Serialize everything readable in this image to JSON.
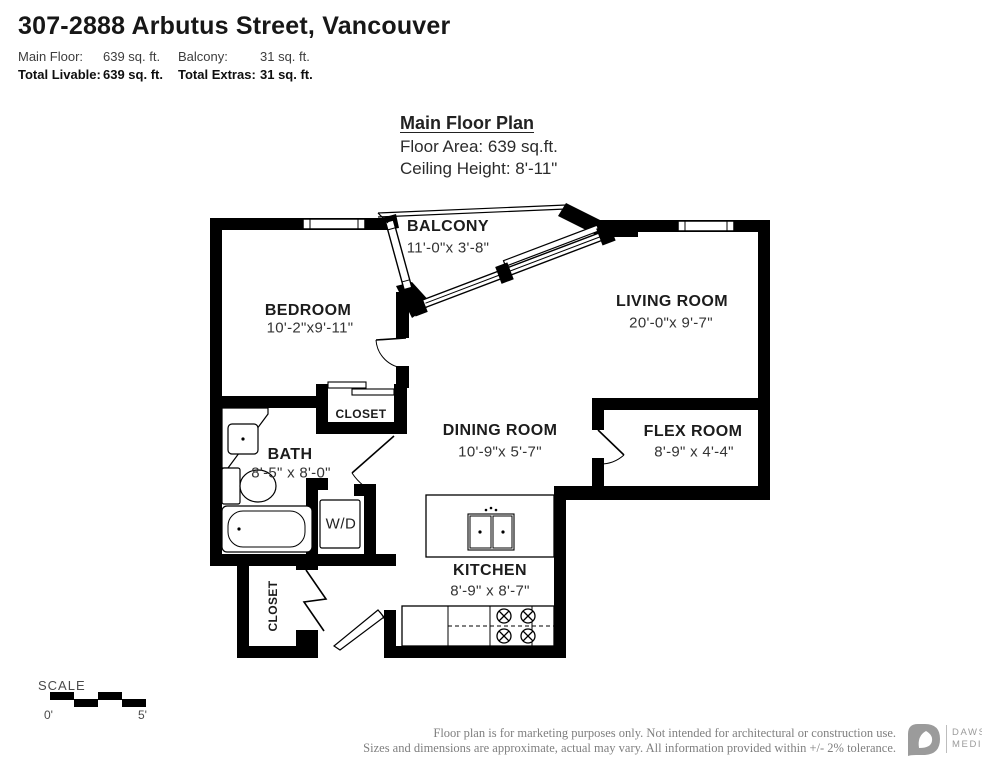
{
  "header": {
    "title": "307-2888 Arbutus Street, Vancouver",
    "stats": {
      "main_floor_label": "Main Floor:",
      "main_floor_value": "639 sq. ft.",
      "balcony_label": "Balcony:",
      "balcony_value": "31 sq. ft.",
      "total_livable_label": "Total Livable:",
      "total_livable_value": "639 sq. ft.",
      "total_extras_label": "Total Extras:",
      "total_extras_value": "31 sq. ft."
    }
  },
  "plan_header": {
    "title": "Main Floor Plan",
    "floor_area": "Floor Area: 639 sq.ft.",
    "ceiling_height": "Ceiling Height: 8'-11\""
  },
  "rooms": {
    "balcony": {
      "name": "BALCONY",
      "dims": "11'-0\"x  3'-8\""
    },
    "bedroom": {
      "name": "BEDROOM",
      "dims": "10'-2\"x9'-11\""
    },
    "living": {
      "name": "LIVING ROOM",
      "dims": "20'-0\"x  9'-7\""
    },
    "dining": {
      "name": "DINING ROOM",
      "dims": "10'-9\"x  5'-7\""
    },
    "flex": {
      "name": "FLEX ROOM",
      "dims": "8'-9\" x 4'-4\""
    },
    "bath": {
      "name": "BATH",
      "dims": "8'-5\" x 8'-0\""
    },
    "kitchen": {
      "name": "KITCHEN",
      "dims": "8'-9\" x 8'-7\""
    },
    "closet_upper": {
      "name": "CLOSET"
    },
    "closet_lower": {
      "name": "CLOSET"
    },
    "wd": {
      "name": "W/D"
    }
  },
  "scale": {
    "label": "SCALE",
    "start": "0'",
    "end": "5'"
  },
  "footer": {
    "line1": "Floor plan is for marketing purposes only. Not intended for architectural or construction use.",
    "line2": "Sizes and dimensions are approximate, actual may vary. All information provided within +/- 2% tolerance.",
    "brand_name": "DAWSON",
    "brand_sub": "MEDIA"
  },
  "colors": {
    "wall": "#000000",
    "footer_text": "#7f7f7f",
    "logo_gray": "#9b9b9b"
  }
}
